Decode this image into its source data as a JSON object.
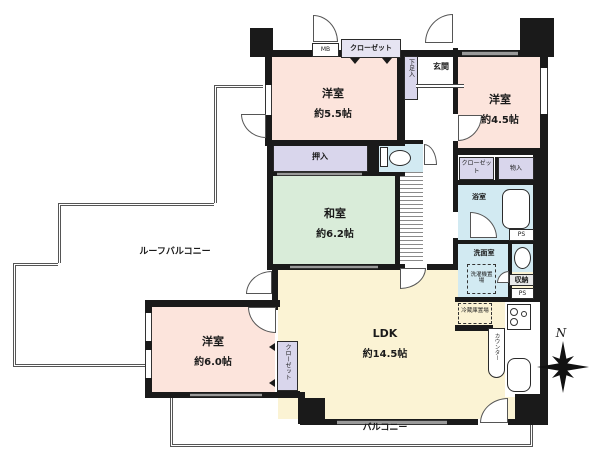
{
  "rooms": {
    "west_bedroom_top": {
      "name": "洋室",
      "size": "約5.5帖"
    },
    "east_bedroom": {
      "name": "洋室",
      "size": "約4.5帖"
    },
    "tatami_room": {
      "name": "和室",
      "size": "約6.2帖"
    },
    "south_bedroom": {
      "name": "洋室",
      "size": "約6.0帖"
    },
    "ldk": {
      "name": "LDK",
      "size": "約14.5帖"
    },
    "entrance": "玄関",
    "bathroom": "浴室",
    "washroom": "洗面室"
  },
  "closets": {
    "closet_top": "クローゼット",
    "closet_east": "クローゼット",
    "storage_east": "物入",
    "shoe_box": "下足入",
    "futon_closet": "押入",
    "closet_south": "クローゼット",
    "storage_small": "収納"
  },
  "utilities": {
    "meter_box": "MB",
    "pipe_space_upper": "PS",
    "pipe_space_lower": "PS",
    "laundry_space": "洗濯機置場",
    "fridge_space": "冷蔵庫置場",
    "counter": "カウンター"
  },
  "outdoor": {
    "roof_balcony": "ルーフバルコニー",
    "balcony": "バルコニー"
  },
  "compass_north": "N",
  "palette": {
    "bedroom_pink": "#fce4dc",
    "tatami_green": "#d9ecd9",
    "ldk_yellow": "#fbf3d4",
    "closet_lavender": "#d9d6ec",
    "wet_area_blue": "#d2eaf2",
    "wall_black": "#1a1a1a"
  }
}
